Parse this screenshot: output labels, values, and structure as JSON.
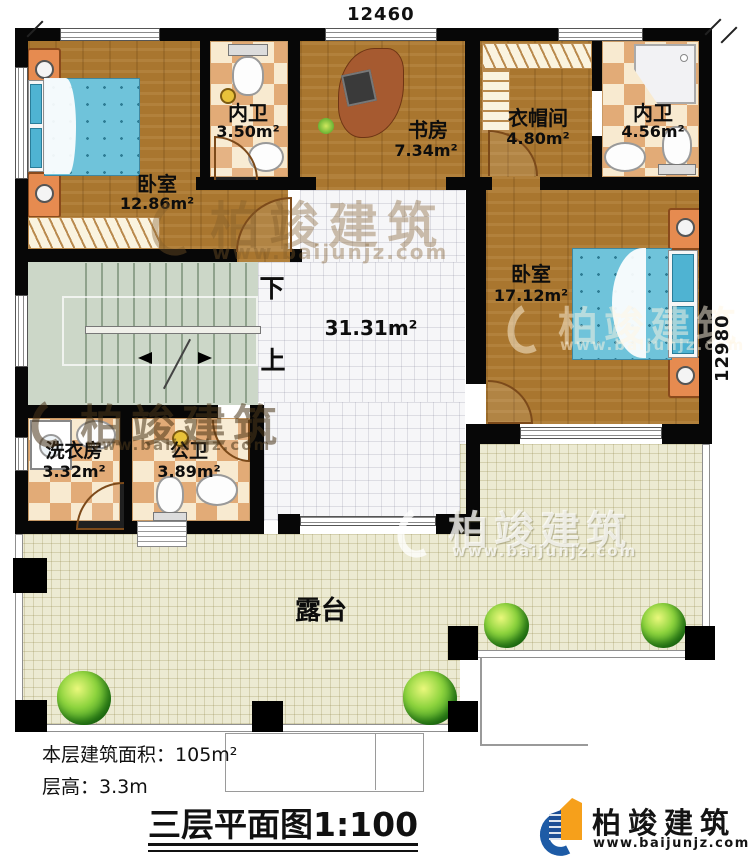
{
  "dimensions": {
    "top": "12460",
    "right": "12980"
  },
  "rooms": {
    "bedroom1": {
      "name": "卧室",
      "area": "12.86m²"
    },
    "bath1": {
      "name": "内卫",
      "area": "3.50m²"
    },
    "study": {
      "name": "书房",
      "area": "7.34m²"
    },
    "closet": {
      "name": "衣帽间",
      "area": "4.80m²"
    },
    "bath2": {
      "name": "内卫",
      "area": "4.56m²"
    },
    "bedroom2": {
      "name": "卧室",
      "area": "17.12m²"
    },
    "laundry": {
      "name": "洗衣房",
      "area": "3.32m²"
    },
    "wc": {
      "name": "公卫",
      "area": "3.89m²"
    }
  },
  "hall": {
    "area": "31.31m²"
  },
  "stairs": {
    "down": "下",
    "up": "上"
  },
  "terrace": {
    "label": "露台"
  },
  "info": {
    "area_label": "本层建筑面积：",
    "area_value": "105m²",
    "height_label": "层高：",
    "height_value": "3.3m"
  },
  "title": {
    "name": "三层平面图",
    "scale": "1:100"
  },
  "brand": {
    "name": "柏竣建筑",
    "url": "www.baijunjz.com"
  },
  "watermark": {
    "line1": "柏竣建筑",
    "line2": "www.baijunjz.com"
  },
  "colors": {
    "wall": "#070707",
    "wood": "#a9762f",
    "tile_light": "#f8ead0",
    "tile_dark": "#e2ab77",
    "hall_tile": "#f6f6f8",
    "terrace": "#ecead2",
    "stairs": "#ccd7c8",
    "bed": "#6fc3da",
    "furniture_orange": "#e68b50",
    "brand_blue": "#1d5ba6",
    "brand_orange": "#f6a01b"
  }
}
